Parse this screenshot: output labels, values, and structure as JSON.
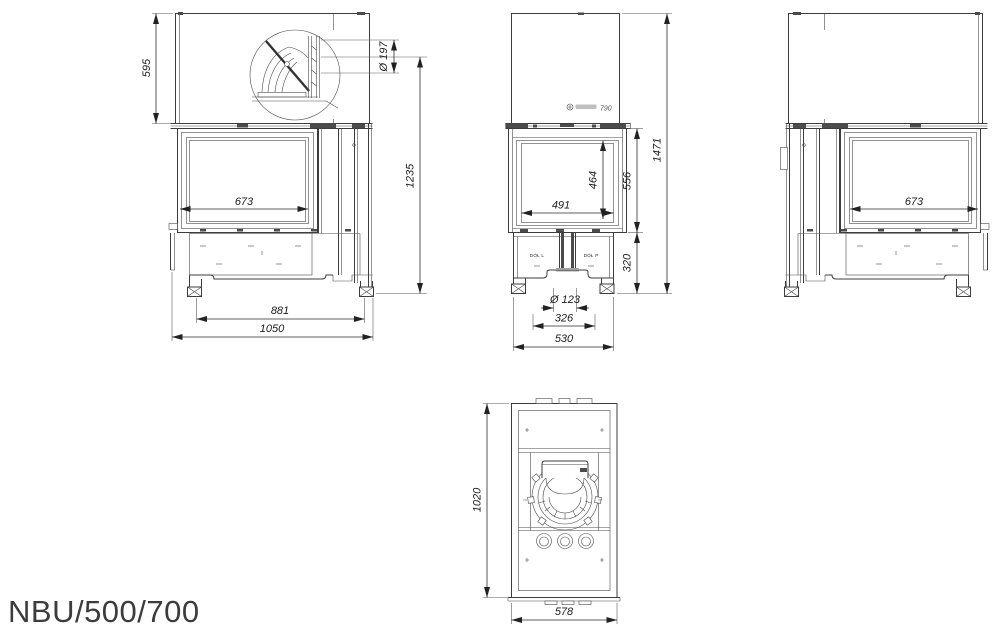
{
  "page": {
    "model_label": "NBU/500/700"
  },
  "colors": {
    "line": "#3d3d3d",
    "dim_text": "#1c1c1c",
    "background": "#ffffff"
  },
  "drawing": {
    "left_view": {
      "hood_height": "595",
      "flue_diameter": "Ø 197",
      "glass_width": "673",
      "height_without_hood": "1235",
      "feet_depth": "881",
      "total_depth": "1050"
    },
    "front_view": {
      "glass_marking": "790",
      "glass_height": "464",
      "firebox_height": "556",
      "total_height": "1471",
      "glass_width": "491",
      "base_height": "320",
      "outlet_left_label": "DÓŁ L",
      "outlet_right_label": "DÓŁ P",
      "outlet_diameter": "Ø 123",
      "outlet_spacing": "326",
      "base_width": "530"
    },
    "right_view": {
      "glass_width": "673"
    },
    "top_view": {
      "body_depth": "1020",
      "body_width": "578"
    }
  }
}
